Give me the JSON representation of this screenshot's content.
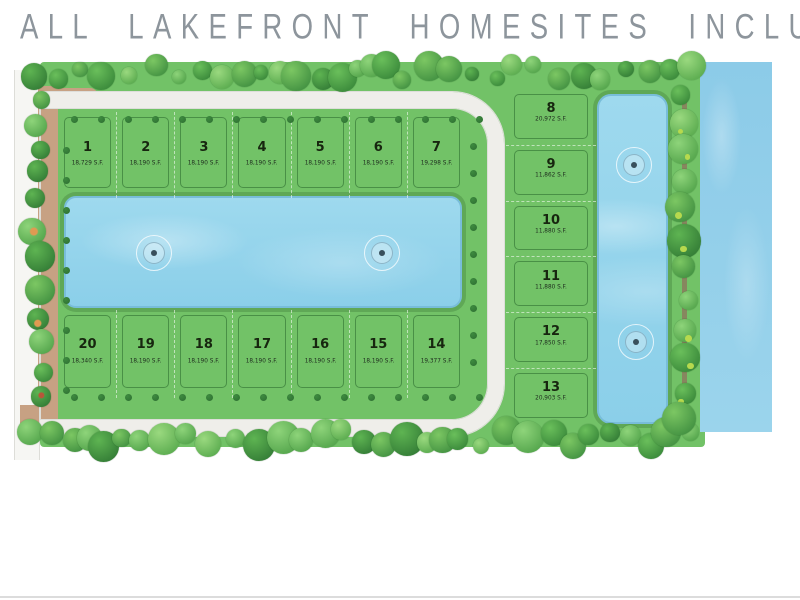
{
  "title": "ALL LAKEFRONT HOMESITES INCLUDED",
  "plan": {
    "top_row_lots": [
      {
        "number": "1",
        "area": "18,729 S.F."
      },
      {
        "number": "2",
        "area": "18,190 S.F."
      },
      {
        "number": "3",
        "area": "18,190 S.F."
      },
      {
        "number": "4",
        "area": "18,190 S.F."
      },
      {
        "number": "5",
        "area": "18,190 S.F."
      },
      {
        "number": "6",
        "area": "18,190 S.F."
      },
      {
        "number": "7",
        "area": "19,298 S.F."
      }
    ],
    "right_column_lots": [
      {
        "number": "8",
        "area": "20,972 S.F."
      },
      {
        "number": "9",
        "area": "11,862 S.F."
      },
      {
        "number": "10",
        "area": "11,880 S.F."
      },
      {
        "number": "11",
        "area": "11,880 S.F."
      },
      {
        "number": "12",
        "area": "17,850 S.F."
      },
      {
        "number": "13",
        "area": "20,903 S.F."
      }
    ],
    "bottom_row_lots": [
      {
        "number": "20",
        "area": "18,340 S.F."
      },
      {
        "number": "19",
        "area": "18,190 S.F."
      },
      {
        "number": "18",
        "area": "18,190 S.F."
      },
      {
        "number": "17",
        "area": "18,190 S.F."
      },
      {
        "number": "16",
        "area": "18,190 S.F."
      },
      {
        "number": "15",
        "area": "18,190 S.F."
      },
      {
        "number": "14",
        "area": "19,377 S.F."
      }
    ],
    "central_lake_fountains": 2,
    "east_lake_fountains": 2
  },
  "icons": {
    "fountain": "concentric-circles",
    "tree": "circle-canopy",
    "street_tree": "dark-green-dot"
  },
  "colors": {
    "title_text": "#8d959c",
    "field_green": "#72c267",
    "lot_line_green": "#2f7d33",
    "road_white": "#efeeea",
    "landscape_tan": "#c7a183",
    "lake_blue": "#95d5ec",
    "lake_edge_blue": "#78bdd9",
    "canal_blue": "#8ccbe8",
    "street_tree_green": "#2d6e31",
    "path_brown": "#8b7c5e"
  }
}
